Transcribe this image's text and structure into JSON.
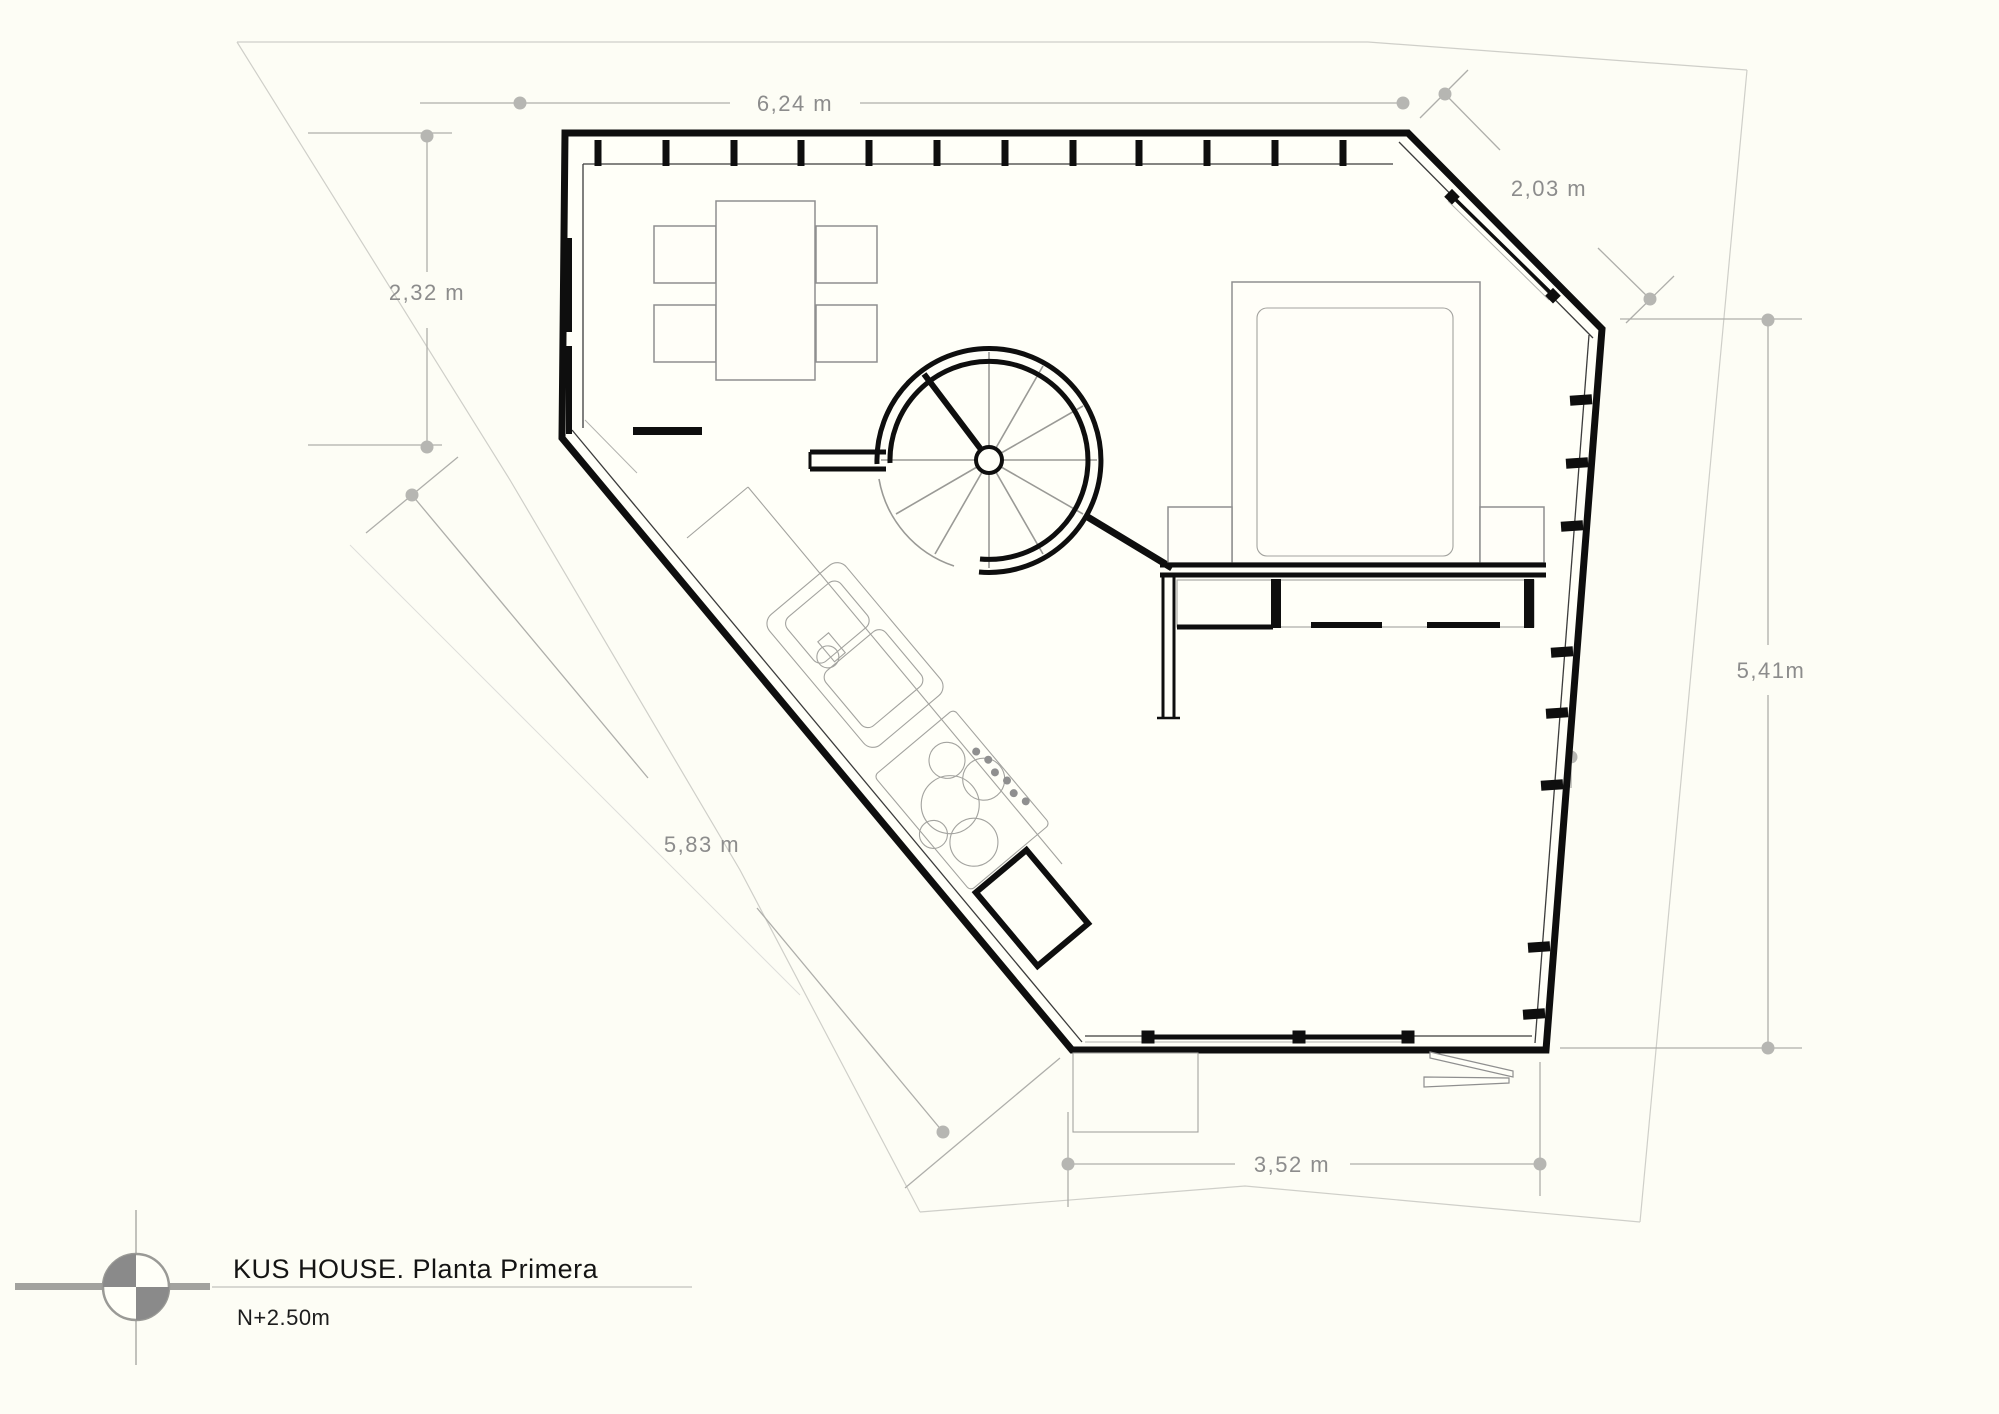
{
  "drawing": {
    "title": "KUS HOUSE. Planta Primera",
    "level": "N+2.50m"
  },
  "dimensions": {
    "top_width": "6,24 m",
    "ne_diagonal_wall": "2,03 m",
    "left_upper_height": "2,32 m",
    "top_door_offset": "0,50 m",
    "bedroom_depth": "2,93 m",
    "right_side_height": "5,41m",
    "bedroom_width": "3,03 m",
    "living_zone_height": "3,46 m",
    "kitchen_wall_length": "5,83 m",
    "bottom_door_offset": "0,50 m",
    "bottom_width": "3,52 m"
  },
  "icons": {
    "north_indicator": "compass-quadrants-icon"
  },
  "colors": {
    "background": "#fdfdf5",
    "wall": "#0e0e0e",
    "dimension_line": "#aeaeaa",
    "dimension_label": "#8c8c8c",
    "property_boundary": "#cfcfc9",
    "furniture": "#8f8f8f",
    "north_symbol": "#8a8a8a"
  }
}
